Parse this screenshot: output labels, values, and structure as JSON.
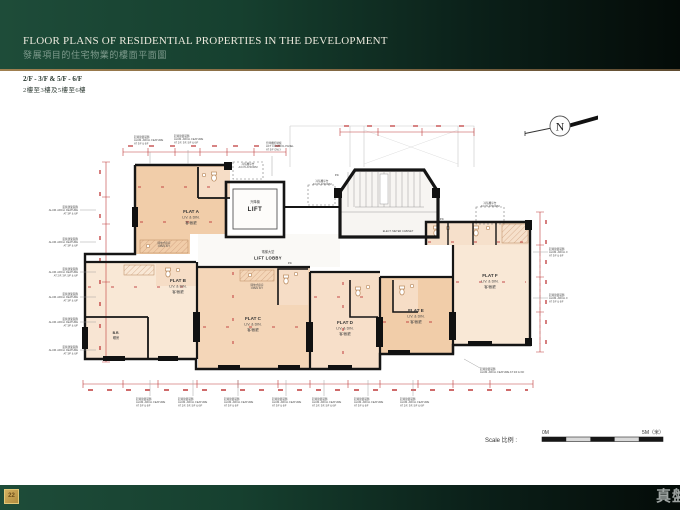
{
  "header": {
    "title_en": "FLOOR PLANS OF RESIDENTIAL PROPERTIES IN THE DEVELOPMENT",
    "title_zh": "發展項目的住宅物業的樓面平面圖"
  },
  "subtitle": {
    "floors_en": "2/F - 3/F & 5/F - 6/F",
    "floors_zh": "2樓至3樓及5樓至6樓"
  },
  "compass": {
    "label": "N"
  },
  "plan": {
    "flats": [
      {
        "name": "FLAT A",
        "livdin": "LIV. & DIN.",
        "zh": "客/飯廳"
      },
      {
        "name": "FLAT B",
        "livdin": "LIV. & DIN.",
        "zh": "客/飯廳"
      },
      {
        "name": "FLAT C",
        "livdin": "LIV. & DIN.",
        "zh": "客/飯廳"
      },
      {
        "name": "FLAT D",
        "livdin": "LIV. & DIN.",
        "zh": "客/飯廳"
      },
      {
        "name": "FLAT E",
        "livdin": "LIV. & DIN.",
        "zh": "客/飯廳"
      },
      {
        "name": "FLAT F",
        "livdin": "LIV. & DIN.",
        "zh": "客/飯廳"
      }
    ],
    "labels": {
      "lift_zh": "升降機",
      "lift_en": "LIFT",
      "lobby_zh": "電梯大堂",
      "lobby_en": "LIFT LOBBY",
      "br_en": "B.R.",
      "br_zh": "睡房",
      "meter": "ELECT. METER CABINET",
      "openkit_zh": "開放式廚房",
      "openkit_en": "OPEN KIT.",
      "pd": "P.D."
    },
    "callouts": {
      "ac_zh": "冷氣機平台",
      "ac_en": "A/C PLATFORM",
      "alum_zh": "鋁質建築裝飾",
      "alum_en": "ALUM. ARCH. FEATURE",
      "alum_at_a": "AT 3/F & 6/F",
      "alum_at_b": "AT 2/F, 3/F, 5/F & 6/F",
      "alum_line": "ALUM. ARCH. FEATURE AT 3/F & 6/F",
      "lcp_zh": "升降機控制板",
      "lcp_en": "LIFT CONTROL PANEL",
      "lcp_at": "AT 5/F ONLY"
    }
  },
  "scalebar": {
    "label": "Scale 比例 :",
    "zero": "0M",
    "five": "5M（米）"
  },
  "footer": {
    "page": "22",
    "logo": "真盤"
  }
}
